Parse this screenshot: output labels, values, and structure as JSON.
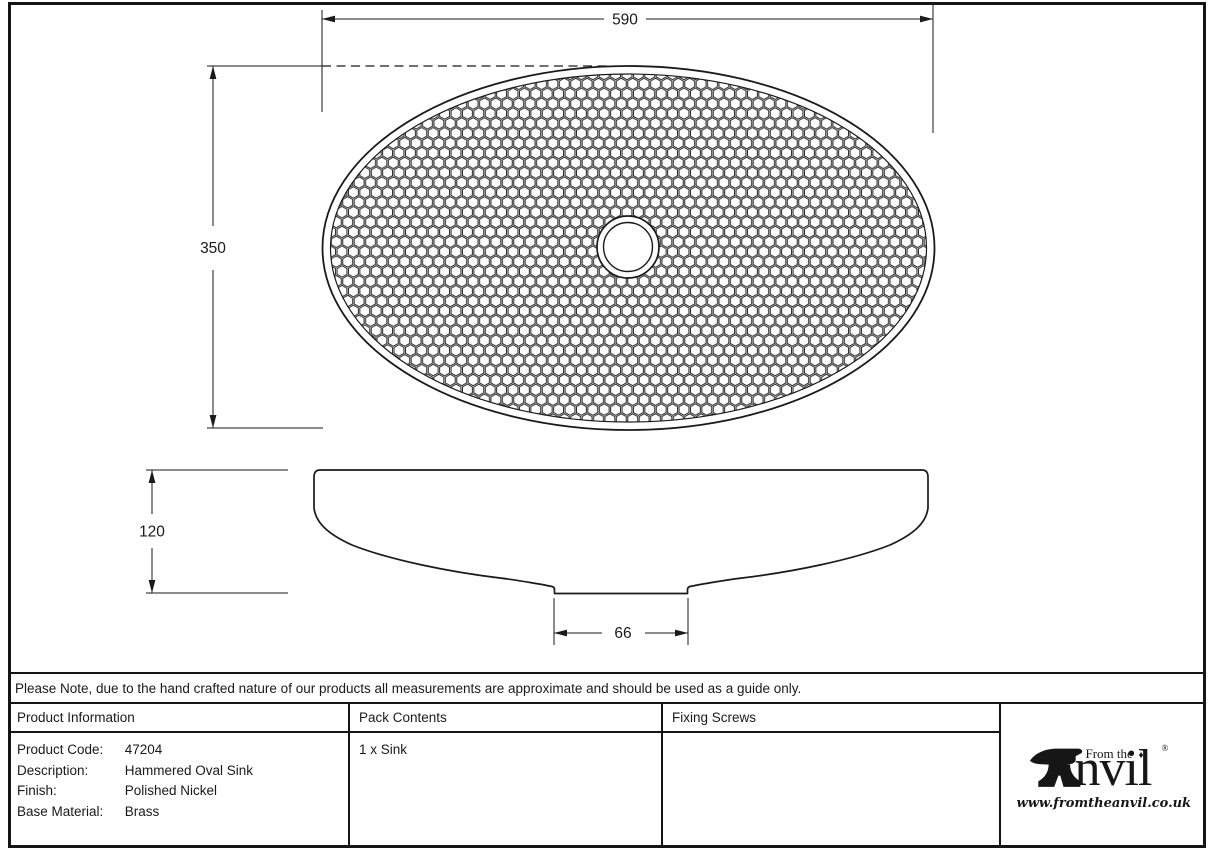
{
  "drawing": {
    "top_view": {
      "width_dim": "590",
      "height_dim": "350"
    },
    "side_view": {
      "height_dim": "120",
      "base_width_dim": "66"
    }
  },
  "note": "Please Note, due to the hand crafted nature of our products all measurements are approximate and should be used as a guide only.",
  "table": {
    "headers": {
      "product_information": "Product Information",
      "pack_contents": "Pack Contents",
      "fixing_screws": "Fixing Screws"
    },
    "product_information": {
      "rows": [
        {
          "label": "Product Code:",
          "value": "47204"
        },
        {
          "label": "Description:",
          "value": "Hammered Oval Sink"
        },
        {
          "label": "Finish:",
          "value": "Polished Nickel"
        },
        {
          "label": "Base Material:",
          "value": "Brass"
        }
      ]
    },
    "pack_contents_value": "1 x Sink",
    "fixing_screws_value": ""
  },
  "logo": {
    "from_the": "From the",
    "name_rest": "nvil",
    "diamond": "♦",
    "registered": "®",
    "url": "www.fromtheanvil.co.uk"
  },
  "colors": {
    "line": "#1a1a1a",
    "background": "#ffffff"
  }
}
